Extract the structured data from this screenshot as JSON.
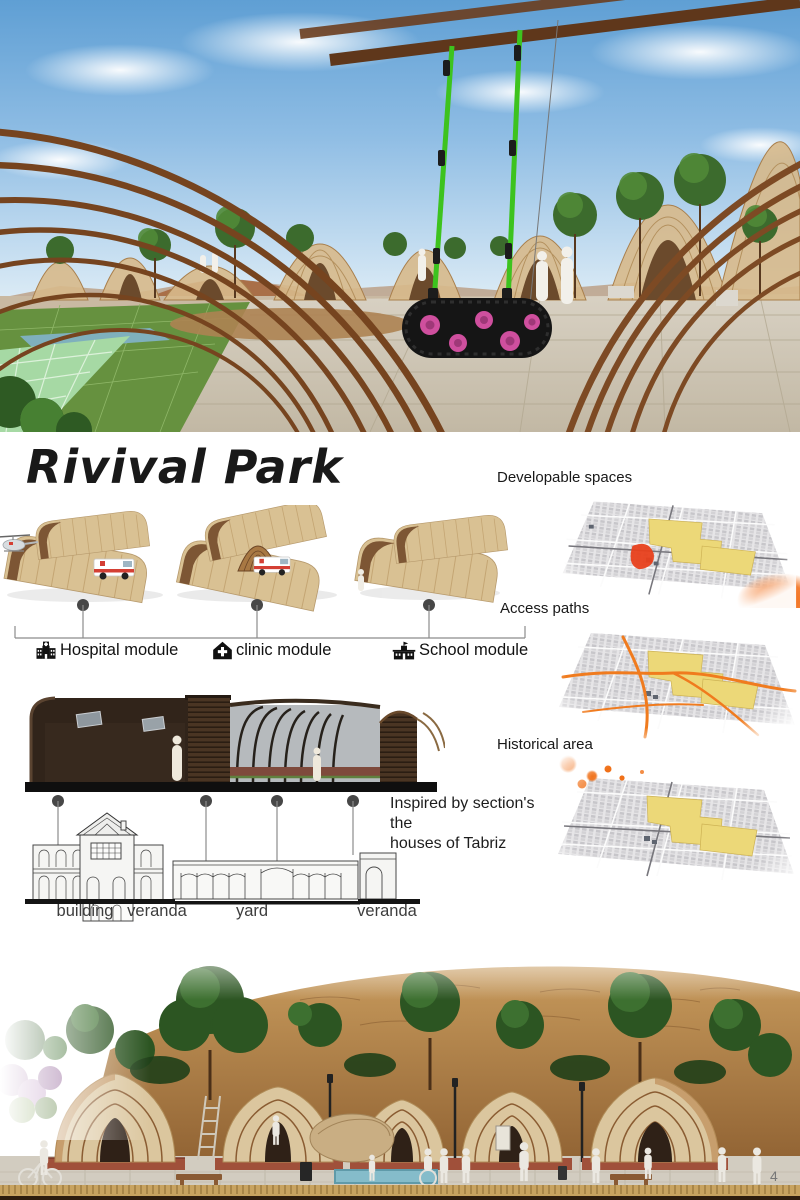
{
  "poster": {
    "title": "Rivival Park",
    "page_number": "4"
  },
  "modules": {
    "items": [
      {
        "label": "Hospital module",
        "icon": "hospital-icon"
      },
      {
        "label": "clinic module",
        "icon": "clinic-icon"
      },
      {
        "label": "School module",
        "icon": "school-icon"
      }
    ]
  },
  "section_note": {
    "line1": "Inspired by section's the",
    "line2": "houses of Tabriz"
  },
  "section_labels": [
    "building",
    "veranda",
    "yard",
    "veranda"
  ],
  "maps": {
    "items": [
      {
        "label": "Developable spaces"
      },
      {
        "label": "Access paths"
      },
      {
        "label": "Historical area"
      }
    ]
  },
  "colors": {
    "wood_dark": "#76441f",
    "module_tan": "#d9c193",
    "zone_yellow": "#ecd878",
    "accent_orange": "#f07018",
    "swing_strap_green": "#3dc31e",
    "tire_pink": "#cf4f9e",
    "platform_brick": "#a0503a"
  }
}
